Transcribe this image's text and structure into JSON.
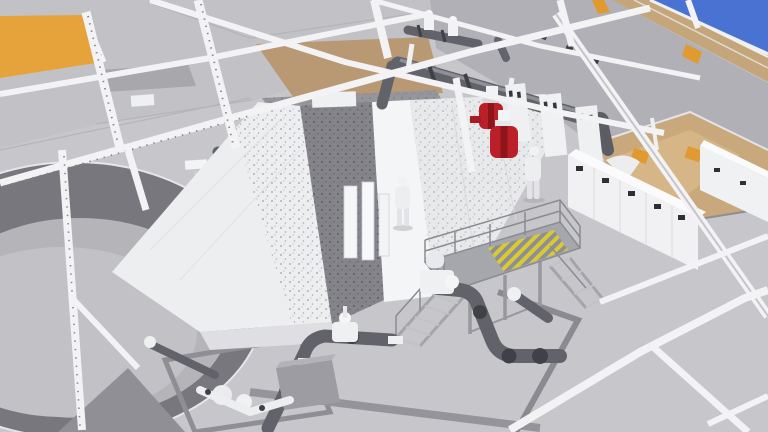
{
  "window": {
    "kind": "3d-model-viewport",
    "width_px": 768,
    "height_px": 432
  },
  "scene": {
    "description": "Isometric BIM rendering of a water treatment plant screening hall with concrete frame, screen tanks, pipework and equipment",
    "visible_text": []
  },
  "palette": {
    "sky": "#4a72d2",
    "concrete_light": "#c7c7cb",
    "concrete_lighter": "#c2c2c6",
    "concrete_mid": "#b0b0b6",
    "concrete_dark": "#95959b",
    "beam_white": "#f3f3f5",
    "roof_orange": "#e6a33b",
    "accent_orange": "#e09a30",
    "mezz_tan": "#b99973",
    "band_tan": "#c4a67a",
    "pit_tan": "#c9a87c",
    "pipe_dark": "#62626a",
    "flange_dark": "#404048",
    "channel_dark": "#84848a",
    "tank_white": "#f1f2f4",
    "valve_red": "#bb2028",
    "grating_olive": "#a8a836",
    "hatch_yellow": "#d9c934",
    "steel_gray": "#9fa0a5",
    "dome_gray": "#b5b5b9",
    "ring_dark": "#77777d",
    "figure_white": "#eceef0"
  },
  "objects": [
    {
      "name": "roof-panel",
      "color": "roof_orange",
      "count": 1
    },
    {
      "name": "sky",
      "color": "sky",
      "count": 1
    },
    {
      "name": "perimeter-wall-band",
      "color": "band_tan",
      "count": 1
    },
    {
      "name": "concrete-frame-beams-columns",
      "color": "beam_white",
      "count": 14
    },
    {
      "name": "screen-tank",
      "color": "tank_white",
      "count": 2
    },
    {
      "name": "water-channel",
      "color": "channel_dark",
      "count": 1
    },
    {
      "name": "clarifier-tank-circular",
      "color": "ring_dark",
      "count": 1
    },
    {
      "name": "overhead-pipe-run",
      "color": "pipe_dark",
      "count": 2
    },
    {
      "name": "red-valve-unit",
      "color": "valve_red",
      "count": 2
    },
    {
      "name": "worker-figure",
      "color": "figure_white",
      "count": 2
    },
    {
      "name": "mcc-cabinet-row",
      "color": "tank_white",
      "count": 2
    },
    {
      "name": "equipment-pit",
      "color": "pit_tan",
      "count": 1
    },
    {
      "name": "junction-box-orange",
      "color": "accent_orange",
      "count": 2
    },
    {
      "name": "access-platform",
      "color": "steel_gray",
      "count": 1
    },
    {
      "name": "yellow-hatched-grating",
      "color": "hatch_yellow",
      "count": 1
    },
    {
      "name": "stair-flight",
      "color": "steel_gray",
      "count": 2
    },
    {
      "name": "floor-pump-assembly",
      "color": "pipe_dark",
      "count": 2
    },
    {
      "name": "pump-skid",
      "color": "tank_white",
      "count": 1
    },
    {
      "name": "trench-grating-panel",
      "color": "grating_olive",
      "count": 2
    },
    {
      "name": "warning-sign",
      "color": "beam_white",
      "count": 1
    },
    {
      "name": "floor-trench",
      "color": "concrete_dark",
      "count": 4
    }
  ]
}
